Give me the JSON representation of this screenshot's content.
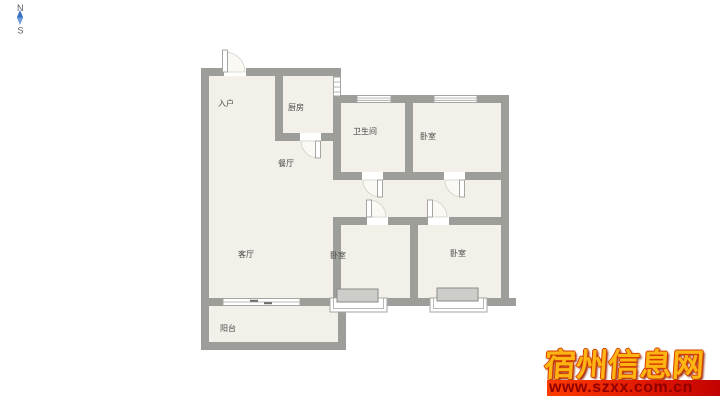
{
  "compass": {
    "north": "N",
    "south": "S"
  },
  "floorplan": {
    "rooms": [
      {
        "id": "entry",
        "label": "入户"
      },
      {
        "id": "kitchen",
        "label": "厨房"
      },
      {
        "id": "bathroom",
        "label": "卫生间"
      },
      {
        "id": "bedroom-top-right",
        "label": "卧室"
      },
      {
        "id": "dining-room",
        "label": "餐厅"
      },
      {
        "id": "living-room",
        "label": "客厅"
      },
      {
        "id": "bedroom-bottom-middle",
        "label": "卧室"
      },
      {
        "id": "bedroom-bottom-right",
        "label": "卧室"
      },
      {
        "id": "balcony",
        "label": "阳台"
      }
    ],
    "colors": {
      "wall": "#9d9d99",
      "floor": "#f2f0e9",
      "label_text": "#4a4a4a",
      "compass_blue_top": "#3a70c2",
      "compass_blue_bottom": "#6f9cd9"
    }
  },
  "watermark": {
    "site_name": "宿州信息网",
    "site_url": "www.szxx.com.cn",
    "colors": {
      "gold": "#fcb513",
      "red_outline": "#d63c00",
      "bar_gradient_start": "#ff3c00",
      "bar_gradient_end": "#c00000",
      "url_text": "#8f0000"
    }
  }
}
